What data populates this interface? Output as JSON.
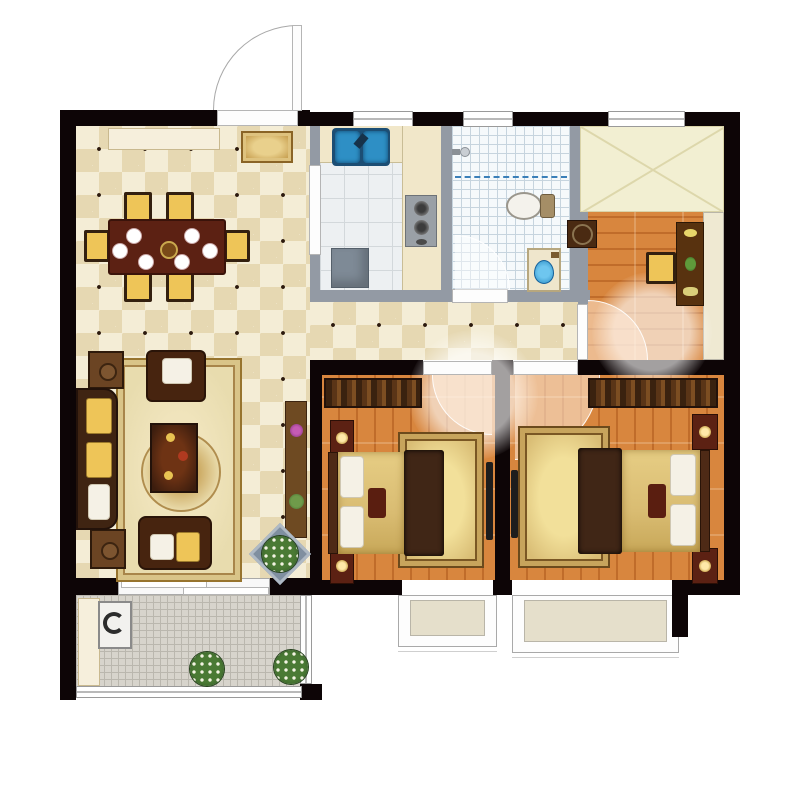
{
  "plan": {
    "type": "apartment-floor-plan-top-view",
    "rooms": [
      {
        "id": "living-dining-room",
        "floor": "beige-diamond-tile",
        "furniture": [
          "sideboard",
          "doormat-rug",
          "dining-table",
          "dining-chairs",
          "dinner-plates",
          "sofa",
          "armchairs",
          "side-tables",
          "coffee-table",
          "ornate-area-rug",
          "tv-cabinet-with-flowers",
          "flower-stand"
        ]
      },
      {
        "id": "kitchen",
        "floor": "white-ceramic-tile",
        "has_window": true,
        "furniture": [
          "double-blue-sink",
          "counter",
          "gas-stove",
          "refrigerator"
        ]
      },
      {
        "id": "bathroom",
        "floor": "blue-mosaic-tile",
        "has_window": true,
        "furniture": [
          "shower-head",
          "shower-curtain-line",
          "toilet",
          "vanity-with-blue-sink"
        ]
      },
      {
        "id": "study",
        "floor": "orange-wood-plank",
        "has_window": true,
        "furniture": [
          "closet-area",
          "round-stool",
          "desk",
          "desk-chair"
        ]
      },
      {
        "id": "bedroom-1",
        "floor": "orange-wood-plank",
        "has_bay_window": true,
        "furniture": [
          "wardrobe",
          "double-bed",
          "nightstands",
          "gold-rug",
          "wall-tv"
        ]
      },
      {
        "id": "bedroom-2",
        "floor": "orange-wood-plank",
        "has_bay_window": true,
        "furniture": [
          "wardrobe",
          "double-bed",
          "nightstands",
          "gold-rug",
          "wall-tv"
        ]
      },
      {
        "id": "balcony",
        "floor": "grey-mosaic-tile",
        "furniture": [
          "washing-machine",
          "cabinet",
          "flower-pots"
        ]
      },
      {
        "id": "hallway",
        "floor": "beige-diamond-tile",
        "furniture": []
      }
    ],
    "doors": [
      "entry-door-top",
      "bathroom-door",
      "study-door",
      "bedroom-1-door",
      "bedroom-2-door",
      "balcony-sliding-door"
    ],
    "counts": {
      "dining_chairs": 6,
      "dinner_plates": 6,
      "bedrooms": 2,
      "bay_windows": 2,
      "balcony_plants": 2,
      "top_wall_windows": 3
    }
  },
  "colors": {
    "wall": "#0d0506",
    "partition": "#939aa4",
    "tile_light": "#f4edd6",
    "tile_dark": "#e6d8b2",
    "tile_dot": "#2b190d",
    "wood": "#d8863e",
    "wood_dark": "#c06c2a",
    "kitchen_floor": "#edf0f2",
    "bath_floor": "#f5f9fb",
    "bath_grid": "#c6d4de",
    "closet_floor": "#f2efd2",
    "balcony_floor": "#d7d4cc",
    "balcony_grid": "#bab7ae",
    "counter": "#f1e7c9",
    "rug_gold": "#e8dcae",
    "rug_border": "#97742e",
    "dark_wood": "#47240f",
    "red_wood": "#5c2113",
    "cushion": "#eec558",
    "pillow": "#f5f1e6",
    "bed_gold": "#d9bc72",
    "bed_runner": "#402616",
    "sink_blue": "#2e8fc5",
    "bay_fill": "#e5dfcb",
    "appliance": "#7e8a96"
  }
}
